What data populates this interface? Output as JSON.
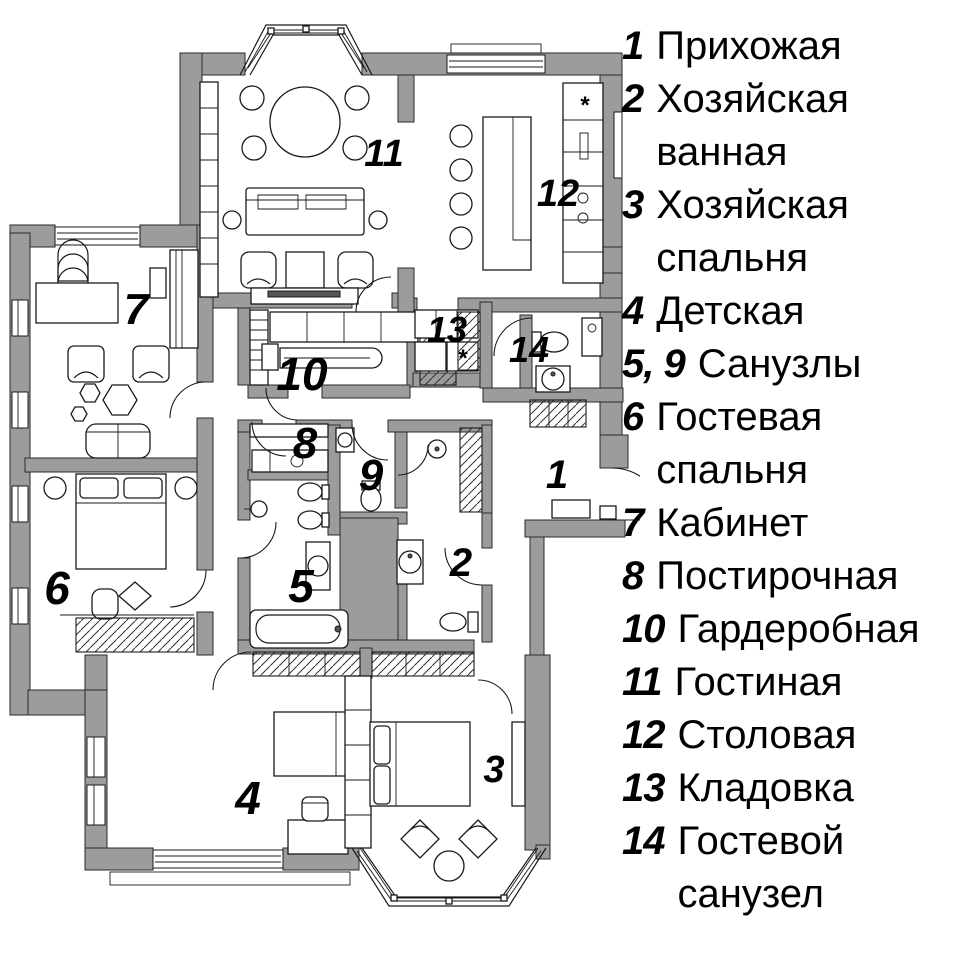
{
  "legend": {
    "items": [
      {
        "num": "1",
        "label": "Прихожая"
      },
      {
        "num": "2",
        "label": "Хозяйская ванная"
      },
      {
        "num": "3",
        "label": "Хозяйская спальня"
      },
      {
        "num": "4",
        "label": "Детская"
      },
      {
        "num": "5, 9",
        "label": "Санузлы"
      },
      {
        "num": "6",
        "label": "Гостевая спальня"
      },
      {
        "num": "7",
        "label": "Кабинет"
      },
      {
        "num": "8",
        "label": "Постирочная"
      },
      {
        "num": "10",
        "label": "Гардеробная"
      },
      {
        "num": "11",
        "label": "Гостиная"
      },
      {
        "num": "12",
        "label": "Столовая"
      },
      {
        "num": "13",
        "label": "Кладовка"
      },
      {
        "num": "14",
        "label": "Гостевой санузел"
      }
    ]
  },
  "plan": {
    "labels": {
      "r1": "1",
      "r2": "2",
      "r3": "3",
      "r4": "4",
      "r5": "5",
      "r6": "6",
      "r7": "7",
      "r8": "8",
      "r9": "9",
      "r10": "10",
      "r11": "11",
      "r12": "12",
      "r13": "13",
      "r14": "14"
    },
    "symbols": {
      "cooktop": "*"
    },
    "colors": {
      "wall_fill": "#9c9c9c",
      "line": "#1a1a1a",
      "background": "#ffffff",
      "text": "#000000"
    }
  }
}
